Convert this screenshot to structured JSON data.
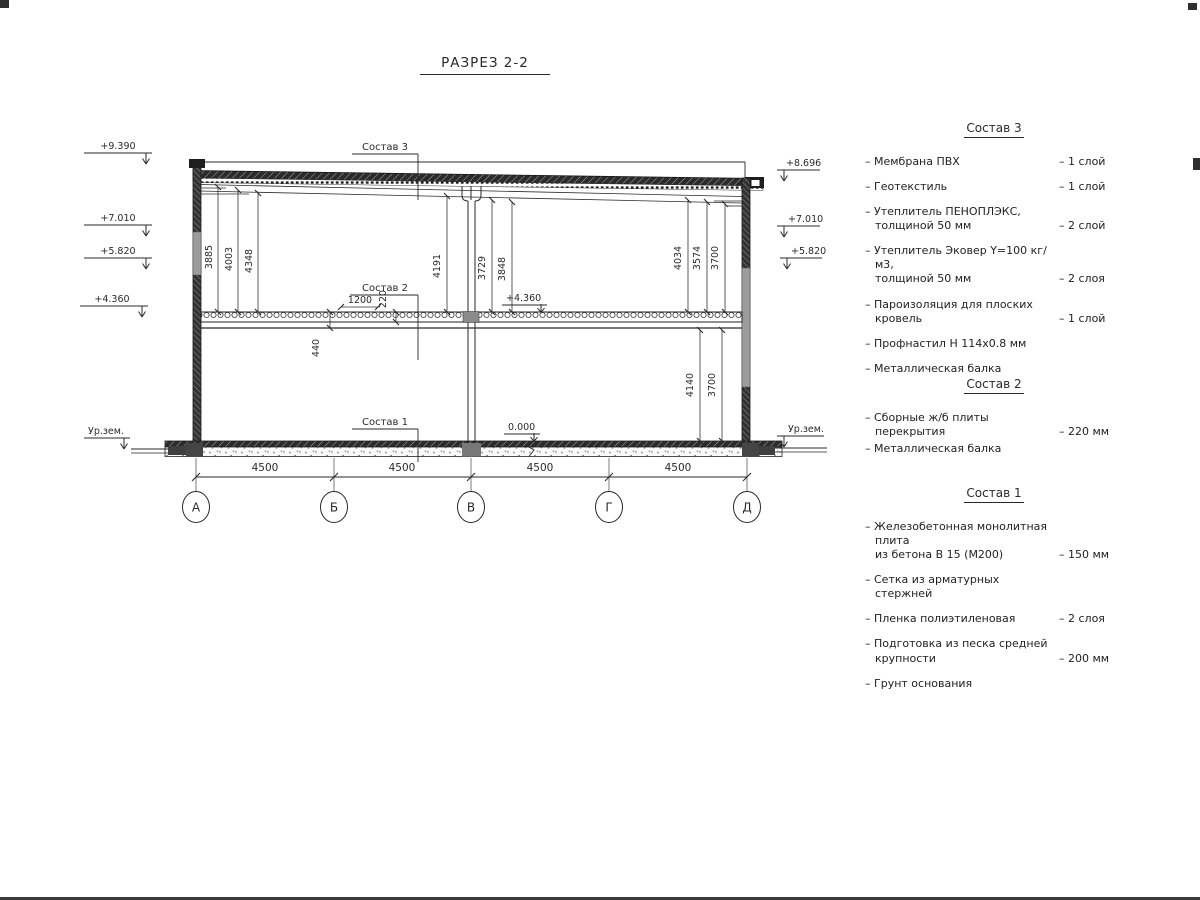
{
  "title": "РАЗРЕЗ 2-2",
  "drawing": {
    "section_labels": {
      "s3": "Состав 3",
      "s2": "Состав 2",
      "s1": "Состав 1"
    },
    "levels_left": [
      "+9.390",
      "+7.010",
      "+5.820",
      "+4.360"
    ],
    "levels_right": [
      "+8.696",
      "+7.010",
      "+5.820"
    ],
    "ground_left": "Ур.зем.",
    "ground_right": "Ур.зем.",
    "level_floor2": "+4.360",
    "level_zero": "0.000",
    "dims_left": [
      "3885",
      "4003",
      "4348"
    ],
    "dims_mid": [
      "4191",
      "3729",
      "3848"
    ],
    "dims_right": [
      "4034",
      "3574",
      "3700"
    ],
    "dim_440": "440",
    "dim_220": "220",
    "dim_1200": "1200",
    "dim_4140": "4140",
    "dim_3700b": "3700",
    "dims_bottom": [
      "4500",
      "4500",
      "4500",
      "4500"
    ],
    "grid": [
      "А",
      "Б",
      "В",
      "Г",
      "Д"
    ]
  },
  "legend": {
    "sections": [
      {
        "title": "Состав 3",
        "items": [
          {
            "name": "– Мембрана ПВХ",
            "qty": "– 1 слой"
          },
          {
            "name": "– Геотекстиль",
            "qty": "– 1 слой"
          },
          {
            "name": "– Утеплитель ПЕНОПЛЭКС,\nтолщиной 50 мм",
            "qty": "– 2 слой"
          },
          {
            "name": "– Утеплитель Эковер Y=100 кг/м3,\nтолщиной 50 мм",
            "qty": "– 2 слоя"
          },
          {
            "name": "– Пароизоляция для плоских кровель",
            "qty": "– 1 слой"
          },
          {
            "name": "– Профнастил Н 114х0.8 мм",
            "qty": ""
          },
          {
            "name": "– Металлическая балка",
            "qty": ""
          }
        ]
      },
      {
        "title": "Состав 2",
        "items": [
          {
            "name": "– Сборные ж/б плиты перекрытия",
            "qty": "– 220 мм"
          },
          {
            "name": "– Металлическая балка",
            "qty": ""
          }
        ]
      },
      {
        "title": "Состав 1",
        "items": [
          {
            "name": "– Железобетонная  монолитная плита\nиз бетона В 15 (М200)",
            "qty": "– 150 мм"
          },
          {
            "name": "– Сетка из арматурных стержней",
            "qty": ""
          },
          {
            "name": "– Пленка полиэтиленовая",
            "qty": "– 2 слоя"
          },
          {
            "name": "– Подготовка из песка средней\nкрупности",
            "qty": "– 200 мм"
          },
          {
            "name": "– Грунт основания",
            "qty": ""
          }
        ]
      }
    ]
  }
}
